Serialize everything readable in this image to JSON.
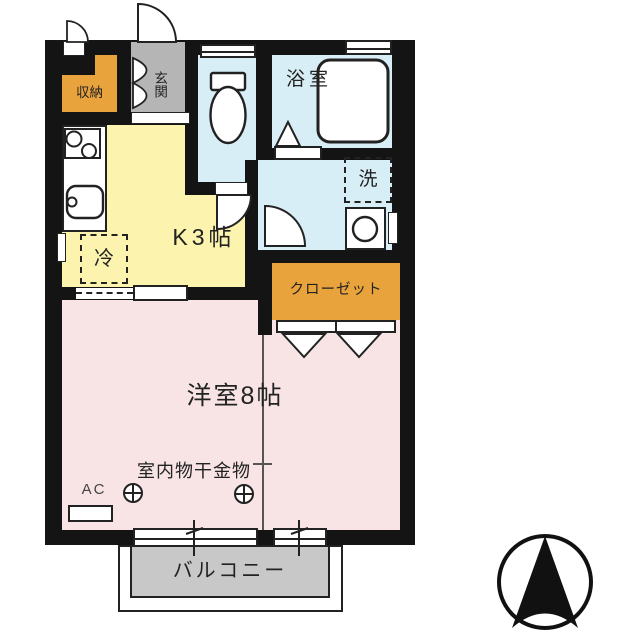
{
  "plan": {
    "rooms": {
      "storage": {
        "label": "収納"
      },
      "entrance": {
        "label": "玄関"
      },
      "bathroom": {
        "label": "浴室"
      },
      "kitchen": {
        "label": "K3帖"
      },
      "closet": {
        "label": "クローゼット"
      },
      "main_room": {
        "label": "洋室8帖"
      },
      "balcony": {
        "label": "バルコニー"
      }
    },
    "fixtures": {
      "refrigerator": {
        "label": "冷"
      },
      "washer_space": {
        "label": "洗"
      },
      "air_conditioner": {
        "label": "AC"
      },
      "indoor_laundry_hardware": {
        "label": "室内物干金物",
        "anchor_symbol": "⊕"
      }
    },
    "icons": {
      "compass": "north-arrow-in-circle",
      "toilet": "toilet-bowl",
      "bathtub": "bathtub",
      "stove": "two-burner-stove",
      "sink": "kitchen-sink",
      "washing_machine": "washing-machine"
    }
  },
  "colors": {
    "wall": "#141414",
    "kitchen": "#fbf3ae",
    "water": "#d7eef6",
    "accent-orange": "#e8a33c",
    "entrance-gray": "#b5b5b5",
    "room-pink": "#f8e4e5",
    "balcony-gray": "#c8c8c8",
    "line": "#222222"
  }
}
